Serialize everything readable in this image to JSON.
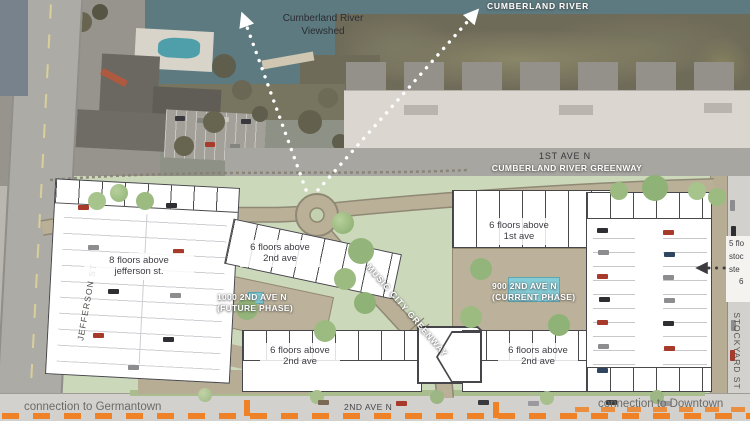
{
  "aerial": {
    "river_label": "CUMBERLAND RIVER",
    "viewshed_line1": "Cumberland River",
    "viewshed_line2": "Viewshed",
    "first_ave_label": "1ST AVE N",
    "greenway_label": "CUMBERLAND RIVER GREENWAY"
  },
  "streets": {
    "jefferson": "JEFFERSON ST",
    "stockyard": "STOCKYARD ST",
    "second_ave": "2ND AVE N"
  },
  "plan": {
    "west_building": {
      "line1": "8 floors above",
      "line2": "jefferson st."
    },
    "future_north": {
      "line1": "6 floors above",
      "line2": "2nd ave"
    },
    "future_court": {
      "name": "1000 2ND AVE N",
      "phase": "(FUTURE PHASE)"
    },
    "future_south": {
      "line1": "6 floors above",
      "line2": "2nd ave"
    },
    "current_north": {
      "line1": "6 floors above",
      "line2": "1st ave"
    },
    "current_court": {
      "name": "900 2ND AVE N",
      "phase": "(CURRENT PHASE)"
    },
    "current_south": {
      "line1": "6 floors above",
      "line2": "2nd ave"
    },
    "music_greenway_label": "MUSIC CITY GREENWAY",
    "east_cutoff": {
      "line1": "5 flo",
      "line2": "stoc",
      "line3": "ste",
      "line4": "6"
    }
  },
  "connections": {
    "germantown": "connection to Germantown",
    "downtown": "connection to Downtown"
  },
  "colors": {
    "river": "#5c7a7f",
    "lawn": "#ccd8ba",
    "path_tan": "#bab098",
    "orange_accent": "#ef8227",
    "pool_blue": "#7fc9d4",
    "building_outline": "#45454a"
  }
}
